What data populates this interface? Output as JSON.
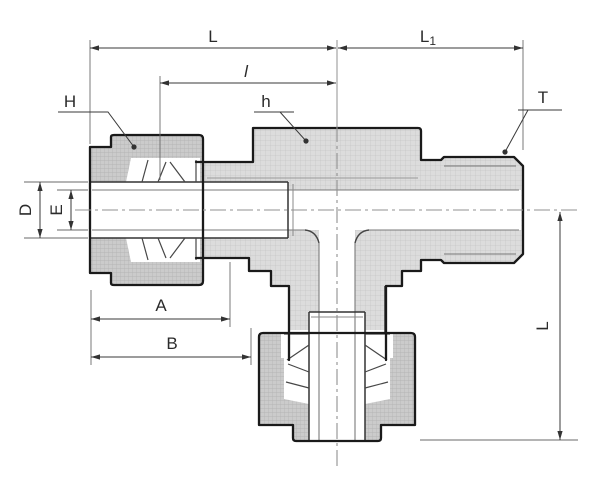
{
  "drawing": {
    "kind": "tube-fitting-branch-tee-cross-section",
    "dimension_labels": {
      "top_length": "L",
      "top_right_length": "L",
      "top_right_length_sub": "1",
      "inner_length": "l",
      "nut_callout": "H",
      "hex_callout": "h",
      "thread_callout": "T",
      "tube_od": "D",
      "bore": "E",
      "length_a": "A",
      "length_b": "B",
      "vertical_length": "L"
    },
    "colors": {
      "background": "#ffffff",
      "outline": "#1a1a1a",
      "body_fill": "#dcdcdc",
      "nut_fill": "#cccccc",
      "dimension_line": "#3a3a3a",
      "centerline": "#909090"
    }
  }
}
